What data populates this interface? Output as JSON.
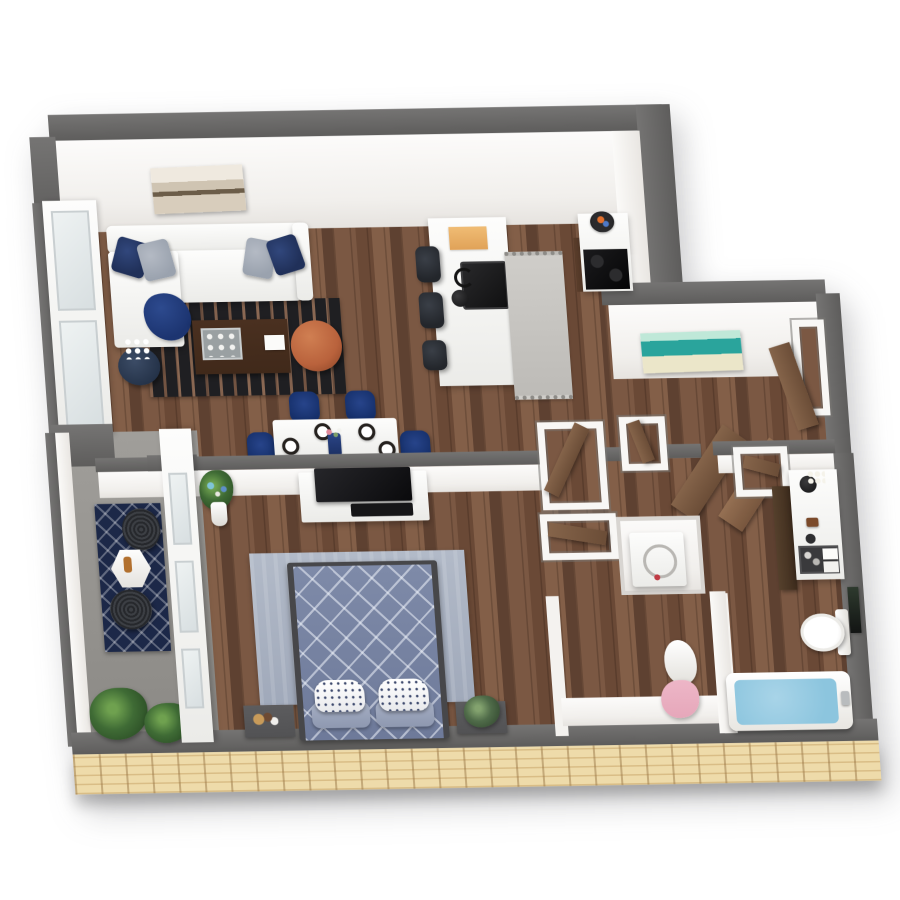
{
  "scene": {
    "type": "3d-floor-plan",
    "description": "Top-down 3D rendering of a one-bedroom, one-bath apartment with balcony",
    "rooms": [
      {
        "name": "living-room",
        "furniture": [
          "white-sectional-sofa",
          "navy-throw-pillows",
          "gray-throw-pillows",
          "navy-throw-blanket",
          "black-area-rug",
          "dark-coffee-table",
          "serving-tray",
          "white-book",
          "copper-pouf",
          "navy-round-side-table",
          "white-flowers",
          "sepia-wall-art"
        ]
      },
      {
        "name": "kitchen",
        "furniture": [
          "white-island",
          "black-sink",
          "faucet",
          "cutting-board",
          "bar-stool",
          "bar-stool",
          "bar-stool",
          "gray-runner-rug",
          "cooktop-counter",
          "fruit-bowl"
        ]
      },
      {
        "name": "dining-area",
        "furniture": [
          "white-dining-table",
          "navy-dining-chair",
          "navy-dining-chair",
          "navy-dining-chair",
          "navy-dining-chair",
          "place-setting",
          "place-setting",
          "place-setting",
          "place-setting",
          "navy-centerpiece-vase"
        ]
      },
      {
        "name": "entry-hall",
        "furniture": [
          "teal-beach-wall-art",
          "entry-door",
          "hall-doorways",
          "closet-door-panels",
          "washer"
        ]
      },
      {
        "name": "bedroom",
        "furniture": [
          "bed-with-diamond-duvet",
          "speckled-pillows",
          "blue-gray-area-rug",
          "nightstand",
          "nightstand",
          "tv-console",
          "flat-tv",
          "floor-flower-vase"
        ]
      },
      {
        "name": "balcony",
        "furniture": [
          "navy-trellis-rug",
          "hex-side-table",
          "mesh-patio-chair",
          "mesh-patio-chair",
          "potted-plants"
        ]
      },
      {
        "name": "walk-in-closet",
        "furniture": [
          "hanging-white-robe",
          "hanging-pink-robe"
        ]
      },
      {
        "name": "bathroom",
        "furniture": [
          "vanity-with-sink",
          "toiletry-tray",
          "towels",
          "linen-cabinet",
          "toilet",
          "framed-art",
          "bathtub-with-water",
          "tub-faucet"
        ]
      }
    ]
  },
  "palette": {
    "wall_cap": "#757473",
    "wall_cap_dark": "#5e5d5c",
    "wood_a": "#7b5843",
    "wood_b": "#6a4936",
    "wood_c": "#835f48",
    "wood_d": "#5e4131",
    "brick_bg": "#eedbaa",
    "brick_line": "#d9bd86",
    "navy": "#203059",
    "steel_gray": "#9aa2ae",
    "rug_black": "#1f1f22",
    "copper": "#b9623c",
    "coffee_table": "#40291a",
    "stool_black": "#23262b",
    "dining_navy": "#16306b",
    "bed_duvet": "#7e8aa8",
    "bed_rug": "#b2bac8",
    "nightstand": "#525254",
    "door_brown": "#85644a",
    "door_brown_dark": "#6b4d37",
    "teal": "#2aa49c",
    "teal_light": "#bfe8d8",
    "cream": "#ebe6c9",
    "tub_water": "#8cc5de",
    "plant_green": "#3f6b35",
    "plant_dark": "#2c4f26",
    "robe_pink": "#e6a7ba",
    "balcony_rug": "#1c2848"
  }
}
